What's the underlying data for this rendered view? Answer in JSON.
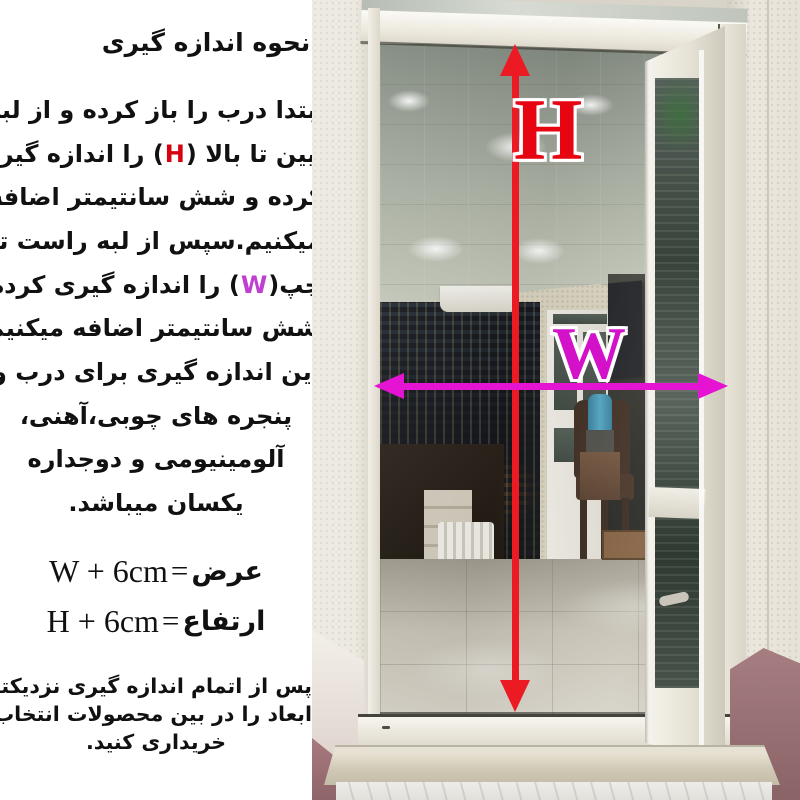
{
  "instructions": {
    "title": "نحوه اندازه گیری",
    "lines": [
      {
        "t": "ابتدا درب را باز کرده و از لبه"
      },
      {
        "pre": "پایین تا بالا (",
        "key": "H",
        "post": ") را اندازه گیری"
      },
      {
        "t": "کرده و شش سانتیمتر اضافه"
      },
      {
        "t": "میکنیم.سپس از لبه راست تا"
      },
      {
        "pre": "چپ(",
        "key": "W",
        "post": ") را اندازه گیری کرده"
      },
      {
        "t": "وشش سانتیمتر اضافه میکنیم."
      },
      {
        "t": "این اندازه گیری برای درب و"
      },
      {
        "t": "پنجره های چوبی،آهنی،"
      },
      {
        "t": "آلومینیومی و دوجداره"
      },
      {
        "t": "یکسان میباشد."
      }
    ]
  },
  "formulas": [
    {
      "label": "عرض",
      "eq": "=",
      "expr": "W + 6cm"
    },
    {
      "label": "ارتفاع",
      "eq": "=",
      "expr": "H + 6cm"
    }
  ],
  "footer": {
    "lines": [
      "پس از اتمام اندازه گیری نزدیکترین",
      "ابعاد را در بین محصولات انتخاب و",
      "خریداری کنید."
    ]
  },
  "photo": {
    "h_label": "H",
    "w_label": "W"
  },
  "colors": {
    "text": "#111111",
    "inline_h_red": "#d7000e",
    "inline_w_magenta": "#bf3fd0",
    "big_h_red": "#e60510",
    "big_w_magenta": "#d211c9",
    "arrow_red": "#ec1b23",
    "arrow_magenta": "#e414d2",
    "panel_background": "#ffffff"
  }
}
